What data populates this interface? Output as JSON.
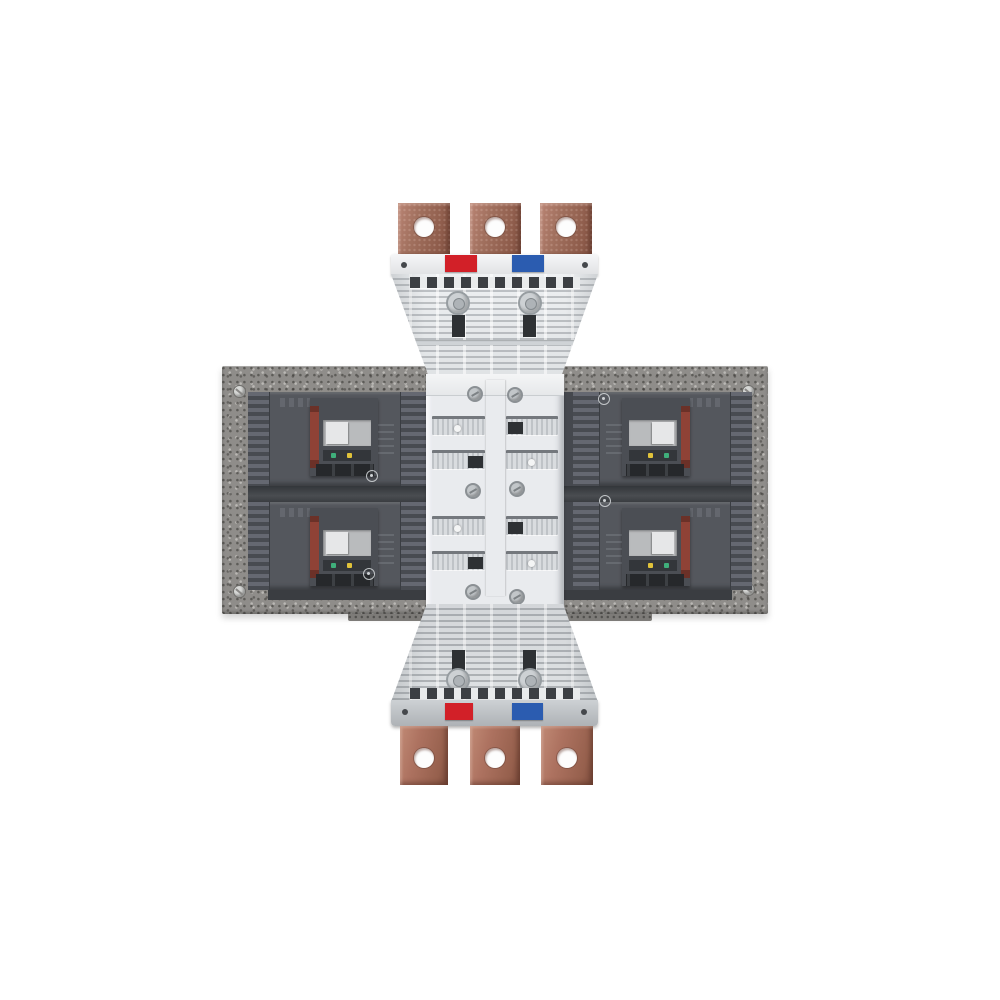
{
  "image": {
    "description": "Product photograph of a busbar adapter assembly: four gray molded-case circuit breakers mounted in pairs on a speckled metal plate, a central white distribution module with a vertical red/white/blue phase stripe, and top and bottom white busbar adapters each terminating in three copper lugs with bolt holes",
    "width": 1000,
    "height": 1000
  },
  "structure": {
    "top_copper_terminals": 3,
    "bottom_copper_terminals": 3,
    "circuit_breakers": 4,
    "phase_marker_colors": [
      "red",
      "blue"
    ],
    "center_stripe_segments": [
      "marker_red",
      "stripe_white",
      "marker_blue",
      "marker_red",
      "stripe_white",
      "marker_blue"
    ]
  },
  "colors": {
    "background": "#ffffff",
    "plate": "#8f8d8a",
    "copper": "#a1705e",
    "copper_light": "#b98474",
    "copper_dark": "#7e4f40",
    "copper_bottom": "#ad7260",
    "marker_red": "#d22028",
    "marker_blue": "#2b5cb0",
    "stripe_white": "#dde0e2",
    "module_white": "#e9ebee",
    "adapter_white": "#eef0f2",
    "adapter_gray": "#dfe2e4",
    "breaker_body": "#54575d",
    "face_red": "#8f4236",
    "toggle": "#e6e7e8",
    "toggle_well": "#b9bbbd",
    "indicator_green": "#3fae7a",
    "indicator_yellow": "#e0c23a",
    "indicator_white": "#e8e8e8",
    "slot_dark": "#2e3134"
  }
}
